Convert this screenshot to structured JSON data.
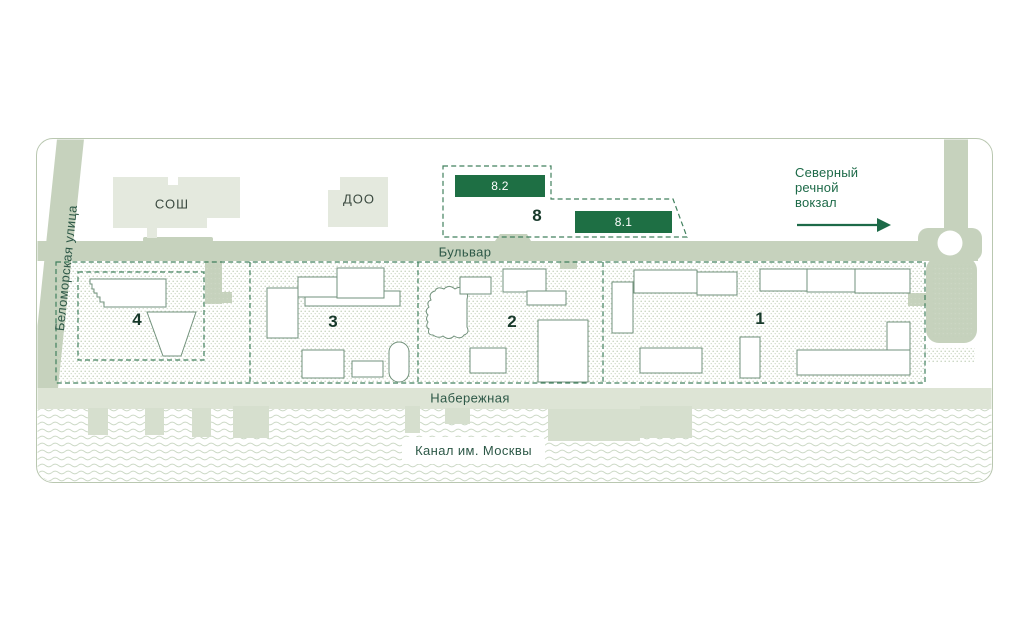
{
  "site_plan": {
    "streets": {
      "left_street": "Беломорская улица",
      "boulevard": "Бульвар",
      "embankment": "Набережная",
      "canal": "Канал им. Москвы"
    },
    "landmarks": {
      "school": "СОШ",
      "kindergarten": "ДОО",
      "terminal_lines": [
        "Северный",
        "речной",
        "вокзал"
      ]
    },
    "plots": {
      "plot1": "1",
      "plot2": "2",
      "plot3": "3",
      "plot4": "4",
      "plot8": "8"
    },
    "units": {
      "unit_8_2": "8.2",
      "unit_8_1": "8.1"
    },
    "icons": {
      "terminal_arrow": "right-arrow-icon"
    },
    "colors": {
      "road": "#c6d2bd",
      "light_building": "#e4e9de",
      "accent_green": "#1e6f44",
      "dashed_border": "#41805e",
      "water_wave": "#cbd8c5",
      "text_green": "#1d6a48"
    }
  }
}
